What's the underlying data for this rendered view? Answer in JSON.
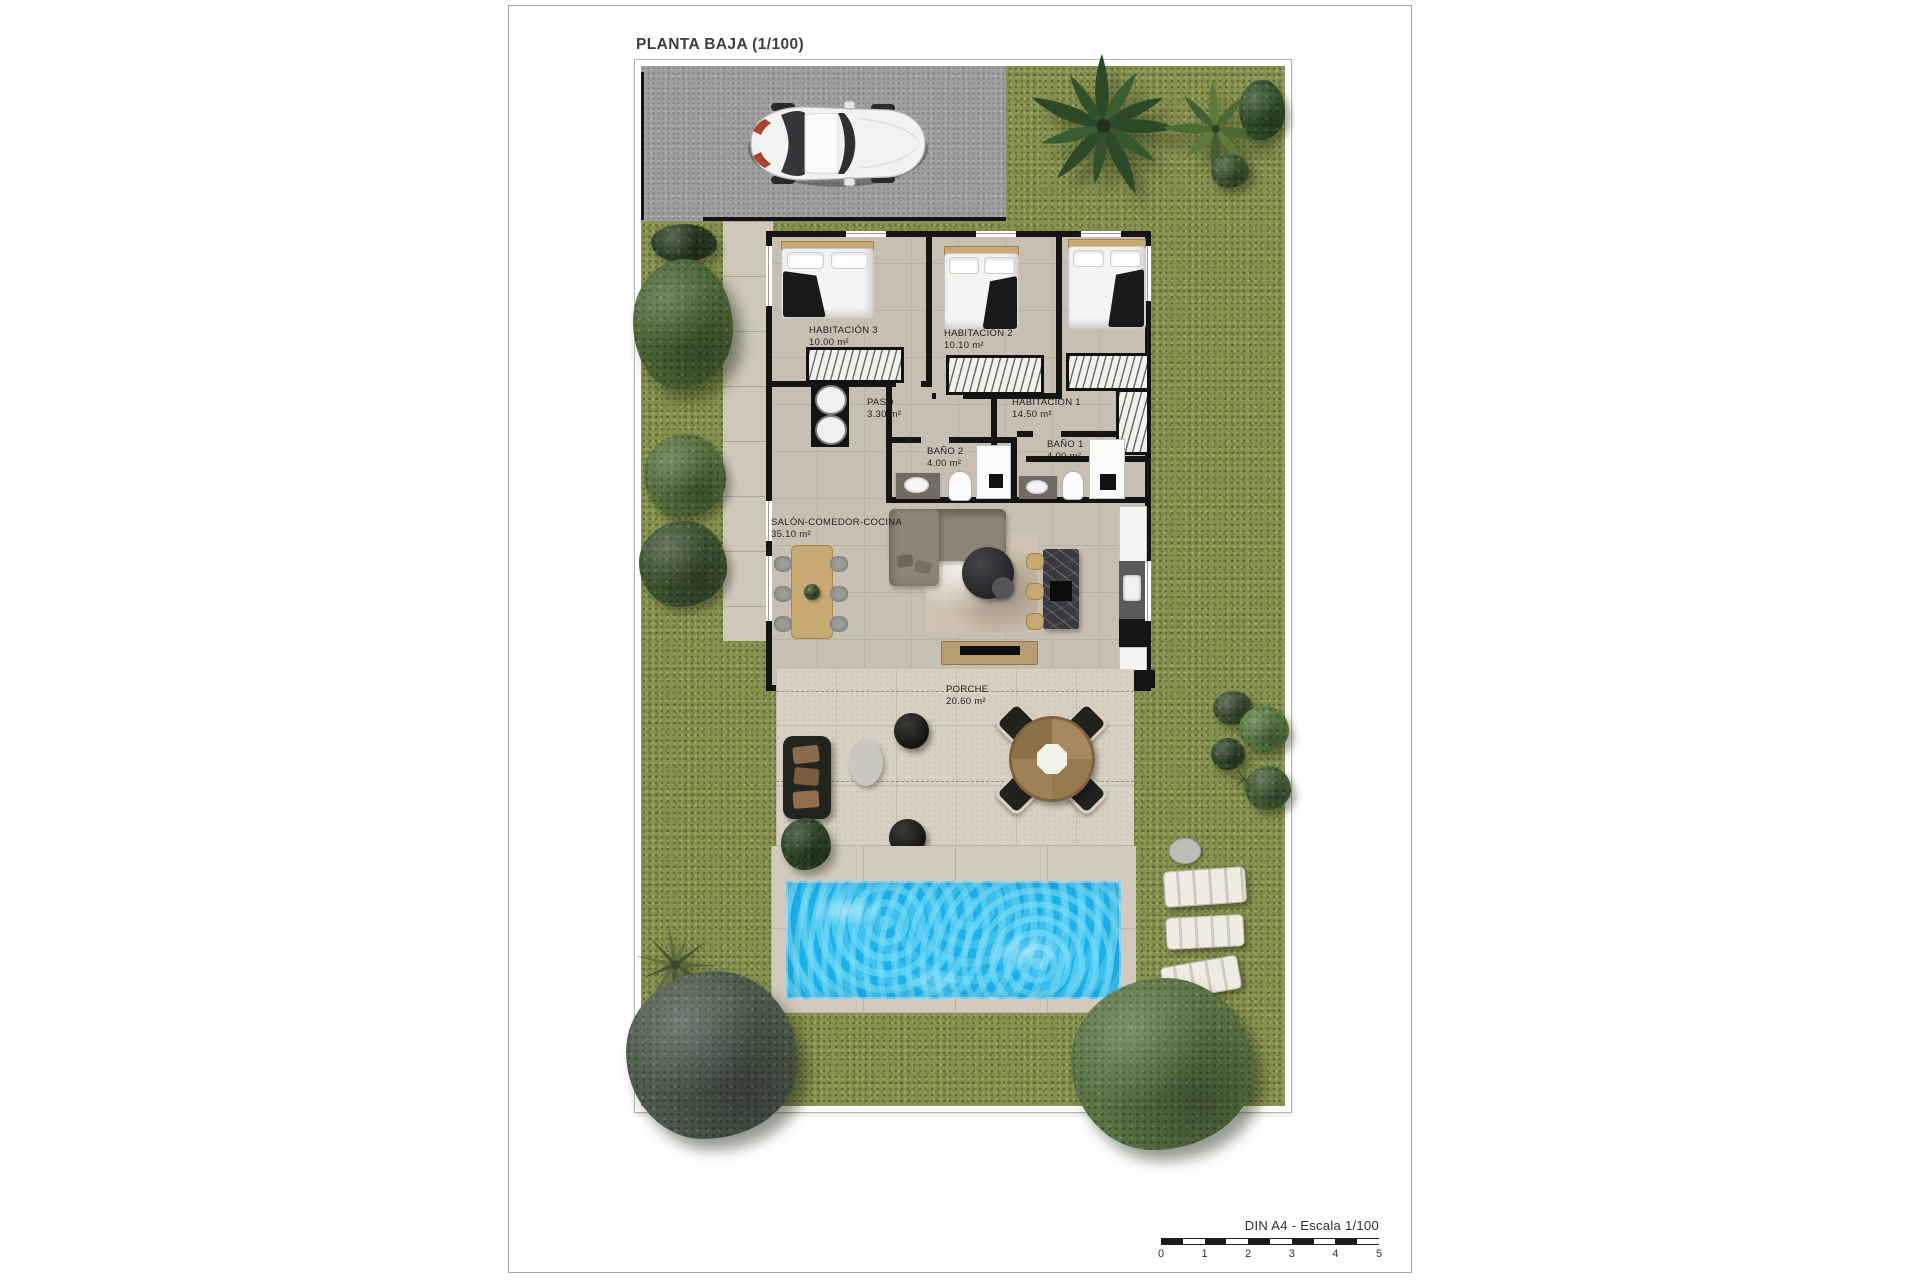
{
  "title": "PLANTA BAJA (1/100)",
  "rooms": {
    "hab3": {
      "name": "HABITACIÓN 3",
      "area": "10.00 m²"
    },
    "hab2": {
      "name": "HABITACIÓN 2",
      "area": "10.10 m²"
    },
    "hab1": {
      "name": "HABITACIÓN 1",
      "area": "14.50 m²"
    },
    "paso": {
      "name": "PASO",
      "area": "3.30 m²"
    },
    "bano2": {
      "name": "BAÑO 2",
      "area": "4.00 m²"
    },
    "bano1": {
      "name": "BAÑO 1",
      "area": "4.00 m²"
    },
    "salon": {
      "name": "SALÓN-COMEDOR-COCINA",
      "area": "35.10 m²"
    },
    "porche": {
      "name": "PORCHE",
      "area": "20.60 m²"
    }
  },
  "scale": {
    "label": "DIN A4 - Escala 1/100",
    "ticks": [
      "0",
      "1",
      "2",
      "3",
      "4",
      "5"
    ]
  },
  "colors": {
    "grass": "#879150",
    "pool": "#1db1e8",
    "driveway": "#9e9e9e",
    "interior_floor": "#c7c0b2",
    "wall": "#141414"
  }
}
